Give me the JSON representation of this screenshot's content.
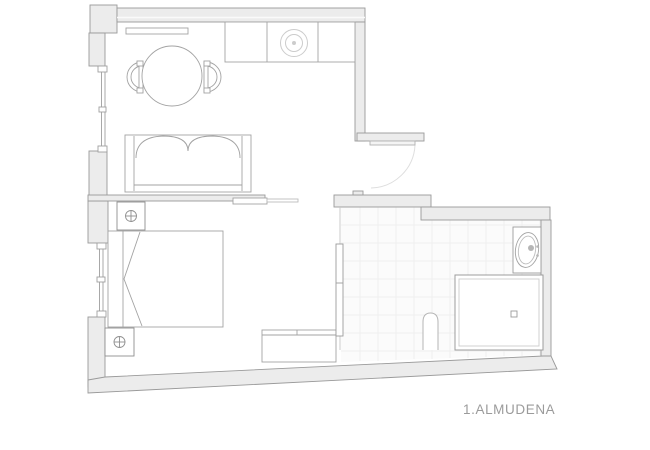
{
  "plan": {
    "title": "1.ALMUDENA",
    "colors": {
      "background": "#ffffff",
      "wall_fill": "#ececec",
      "wall_stroke": "#9a9a9a",
      "furniture_stroke": "#a3a3a3",
      "light_stroke": "#c9c9c9",
      "tile_line": "#efefef",
      "title_text": "#9b9b9b"
    }
  }
}
